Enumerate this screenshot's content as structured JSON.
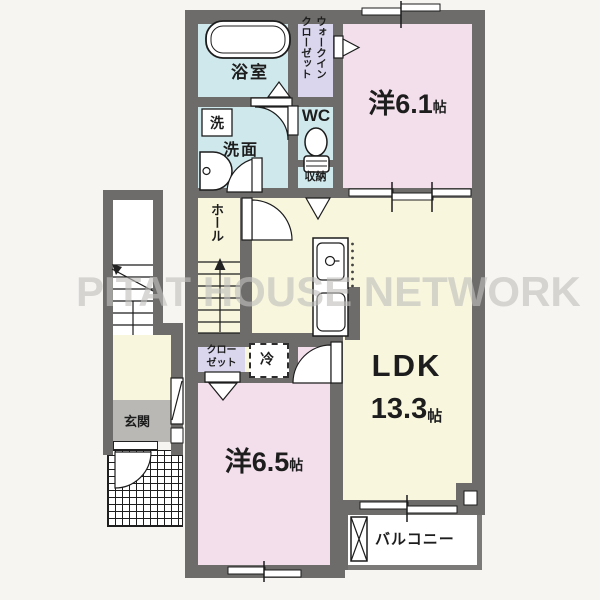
{
  "watermark": "PITAT HOUSE NETWORK",
  "labels": {
    "bath": "浴室",
    "wic_col1": "ウォークイン",
    "wic_col2": "クローゼット",
    "room61_name": "洋6.1",
    "room61_unit": "帖",
    "washer": "洗",
    "senmen": "洗面",
    "wc": "WC",
    "shuno": "収納",
    "hall": "ホール",
    "closet_line1": "クロー",
    "closet_line2": "ゼット",
    "fridge": "冷",
    "ldk_name": "LDK",
    "ldk_size": "13.3",
    "ldk_unit": "帖",
    "room65_name": "洋6.5",
    "room65_unit": "帖",
    "genkan": "玄関",
    "balcony": "バルコニー"
  },
  "colors": {
    "wall": "#6d6c6a",
    "wet": "#cfe8ec",
    "closetc": "#d9d6ed",
    "bedroom": "#f2dfeb",
    "living": "#f8f6dd",
    "genkanf": "#b9b8b5",
    "bg": "#f7f5f2",
    "line": "#1c1c1c",
    "watermark": "#c1c0be"
  }
}
